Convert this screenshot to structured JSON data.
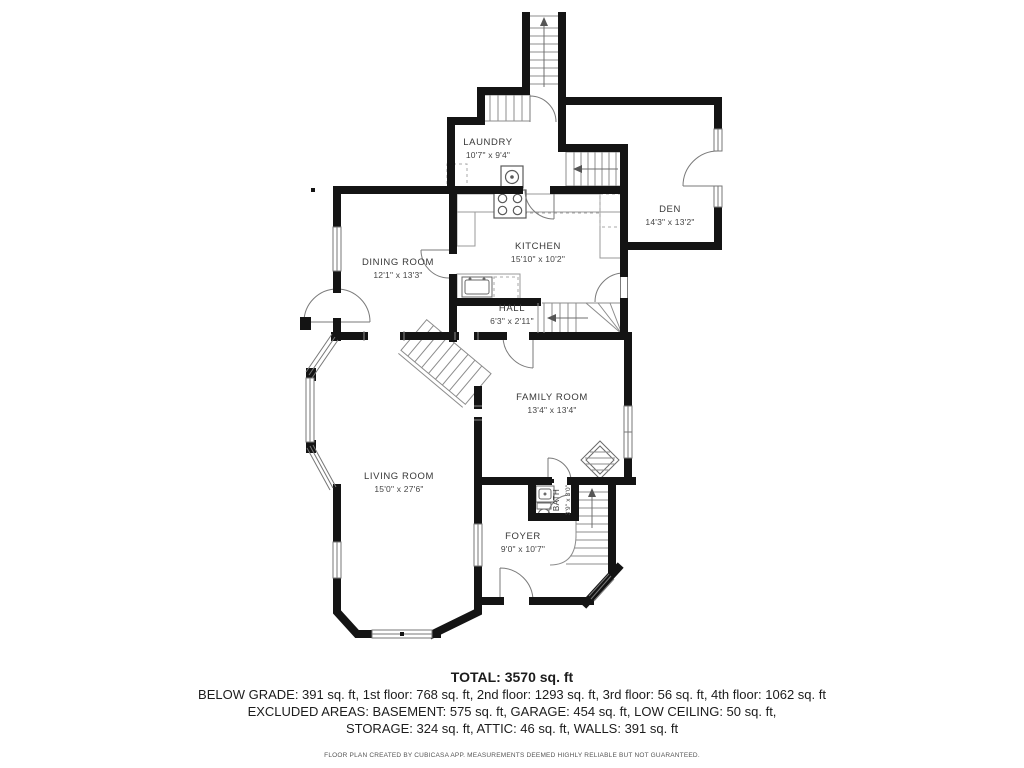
{
  "title": "Floor plan",
  "rooms": [
    {
      "name": "LAUNDRY",
      "dims": "10'7\" x 9'4\""
    },
    {
      "name": "DEN",
      "dims": "14'3\" x 13'2\""
    },
    {
      "name": "KITCHEN",
      "dims": "15'10\" x 10'2\""
    },
    {
      "name": "DINING ROOM",
      "dims": "12'1\" x 13'3\""
    },
    {
      "name": "HALL",
      "dims": "6'3\" x 2'11\""
    },
    {
      "name": "FAMILY ROOM",
      "dims": "13'4\" x 13'4\""
    },
    {
      "name": "LIVING ROOM",
      "dims": "15'0\" x 27'6\""
    },
    {
      "name": "FOYER",
      "dims": "9'0\" x 10'7\""
    },
    {
      "name": "BATH",
      "dims": "3'9\" x 3'0\""
    }
  ],
  "summary": {
    "total": "TOTAL: 3570 sq. ft",
    "line1": "BELOW GRADE: 391 sq. ft, 1st floor: 768 sq. ft, 2nd floor: 1293 sq. ft, 3rd floor: 56 sq. ft, 4th floor: 1062 sq. ft",
    "line2": "EXCLUDED AREAS: BASEMENT: 575 sq. ft, GARAGE: 454 sq. ft, LOW CEILING: 50 sq. ft,",
    "line3": "STORAGE: 324 sq. ft, ATTIC: 46 sq. ft, WALLS: 391 sq. ft",
    "disclaimer": "FLOOR PLAN CREATED BY CUBICASA APP. MEASUREMENTS DEEMED HIGHLY RELIABLE BUT NOT GUARANTEED."
  },
  "fixtures": [
    "stove-icon",
    "washer-icon",
    "kitchen-sink-icon",
    "dishwasher-icon",
    "bath-sink-icon",
    "toilet-icon",
    "fireplace-icon",
    "stairs-icon",
    "door-arc-icon",
    "window-icon"
  ],
  "colors": {
    "wall": "#141414",
    "thin_line": "#8c8c8c",
    "text": "#383838",
    "background": "#ffffff"
  }
}
